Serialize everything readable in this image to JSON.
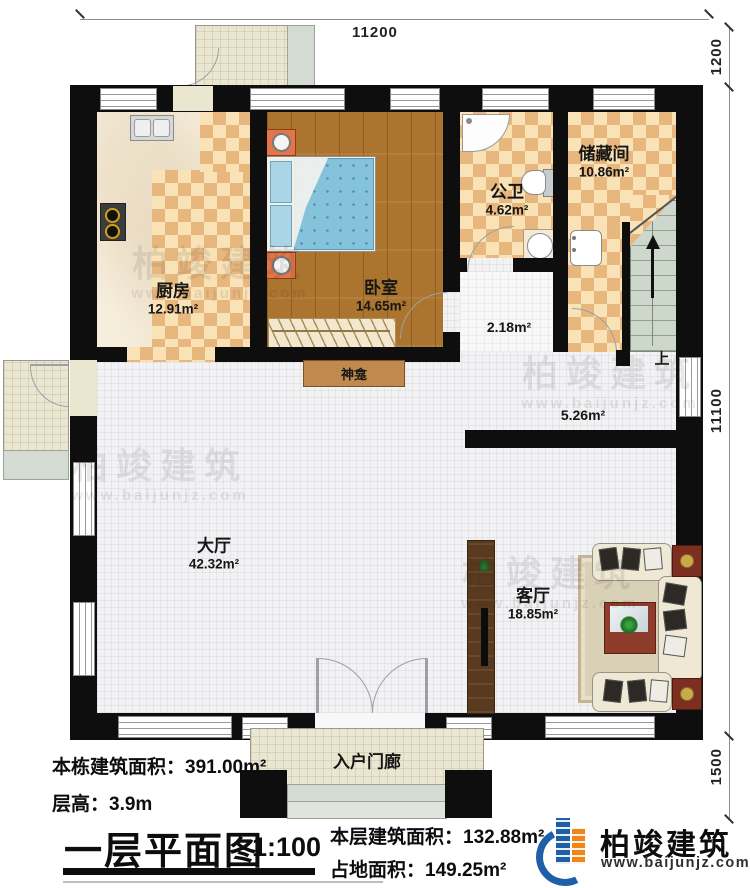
{
  "dimensions": {
    "top": "11200",
    "top_right": "1200",
    "right": "11100",
    "bottom_right": "1500"
  },
  "rooms": {
    "kitchen": {
      "name": "厨房",
      "area": "12.91m²"
    },
    "bedroom": {
      "name": "卧室",
      "area": "14.65m²"
    },
    "bathroom": {
      "name": "公卫",
      "area": "4.62m²"
    },
    "storage": {
      "name": "储藏间",
      "area": "10.86m²"
    },
    "hall": {
      "name": "大厅",
      "area": "42.32m²"
    },
    "living": {
      "name": "客厅",
      "area": "18.85m²"
    },
    "corridor_small": {
      "area": "2.18m²"
    },
    "corridor_large": {
      "area": "5.26m²"
    },
    "shrine": {
      "name": "神龛"
    },
    "entry_porch": {
      "name": "入户门廊"
    },
    "stairs": {
      "up_label": "上"
    }
  },
  "title_block": {
    "building_total_area": "本栋建筑面积：391.00m²",
    "floor_height": "层高：3.9m",
    "plan_title": "一层平面图",
    "scale": "1:100",
    "floor_area": "本层建筑面积：132.88m²",
    "footprint_area": "占地面积：149.25m²"
  },
  "brand": {
    "logo_text": "柏竣建筑",
    "website": "www.baijunjz.com"
  },
  "watermark": {
    "text": "柏竣建筑",
    "url": "www.baijunjz.com"
  },
  "colors": {
    "wall": "#0e0e0e",
    "checker_dark": "#e8b77e",
    "checker_light": "#f8e2b6",
    "wood_floor": "#ab742f",
    "logo_blue": "#1f5fa8",
    "logo_orange": "#f08519"
  }
}
